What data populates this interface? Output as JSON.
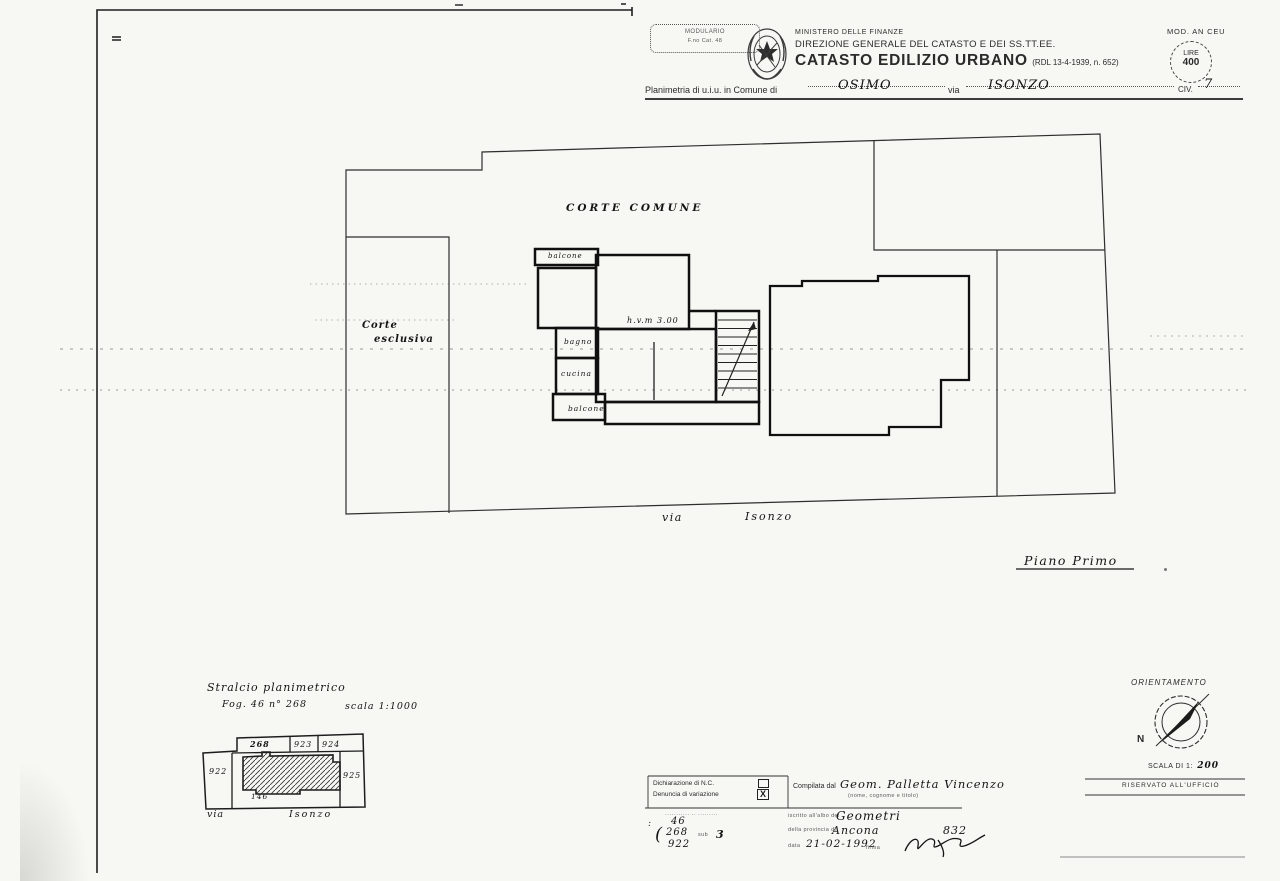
{
  "header": {
    "stamp": {
      "line1": "MODULARIO",
      "line2": "F.no Cat. 48"
    },
    "ministry": "MINISTERO DELLE FINANZE",
    "directorate": "DIREZIONE GENERALE DEL CATASTO E DEI SS.TT.EE.",
    "title": "CATASTO EDILIZIO URBANO",
    "title_ref": "(RDL 13-4-1939, n. 652)",
    "mod": "MOD. AN CEU",
    "revenue_stamp": {
      "line1": "LIRE",
      "line2": "400"
    },
    "planimetria": {
      "label": "Planimetria di u.i.u. in Comune di",
      "comune": "OSIMO",
      "via_label": "via",
      "via": "ISONZO",
      "civ_label": "CIV.",
      "civ": "7"
    }
  },
  "plan": {
    "corte_comune": "CORTE COMUNE",
    "corte_esclusiva_line1": "Corte",
    "corte_esclusiva_line2": "esclusiva",
    "balcone_top": "balcone",
    "bagno": "bagno",
    "cucina": "cucina",
    "balcone_bottom": "balcone",
    "height_note": "h.v.m 3.00",
    "street_via": "via",
    "street_name": "Isonzo",
    "floor": "Piano Primo"
  },
  "stralcio": {
    "title": "Stralcio planimetrico",
    "sheet": "Fog. 46 n° 268",
    "scale": "scala 1:1000",
    "p268": "268",
    "p923": "923",
    "p924": "924",
    "p922": "922",
    "p925": "925",
    "p146": "146",
    "street_via": "via",
    "street_name": "Isonzo"
  },
  "orientation": {
    "title": "ORIENTAMENTO",
    "north": "N",
    "scale_prefix": "SCALA DI 1:",
    "scale_value": "200"
  },
  "form": {
    "declaration": "Dichiarazione di N.C.",
    "variation": "Denuncia di variazione",
    "variation_mark": "X",
    "compiled_label": "Compilata dal",
    "compiled_by": "Geom. Palletta Vincenzo",
    "compiled_note": "(nome, cognome e titolo)",
    "reserved": "RISERVATO ALL'UFFICIO",
    "micro_row": "··········· ·· ·········",
    "colon_mark": ":",
    "foglio_value": "46",
    "mappale_value": "268",
    "brace": "(",
    "mappale2_value": "922",
    "sub_label": "sub",
    "sub_value": "3",
    "albo_label": "iscritto all'albo dei",
    "albo_value": "Geometri",
    "prov_label": "della provincia di",
    "prov_value": "Ancona",
    "reg_number": "832",
    "date_label": "data",
    "date_value": "21-02-1992",
    "firma_label": "firma"
  }
}
